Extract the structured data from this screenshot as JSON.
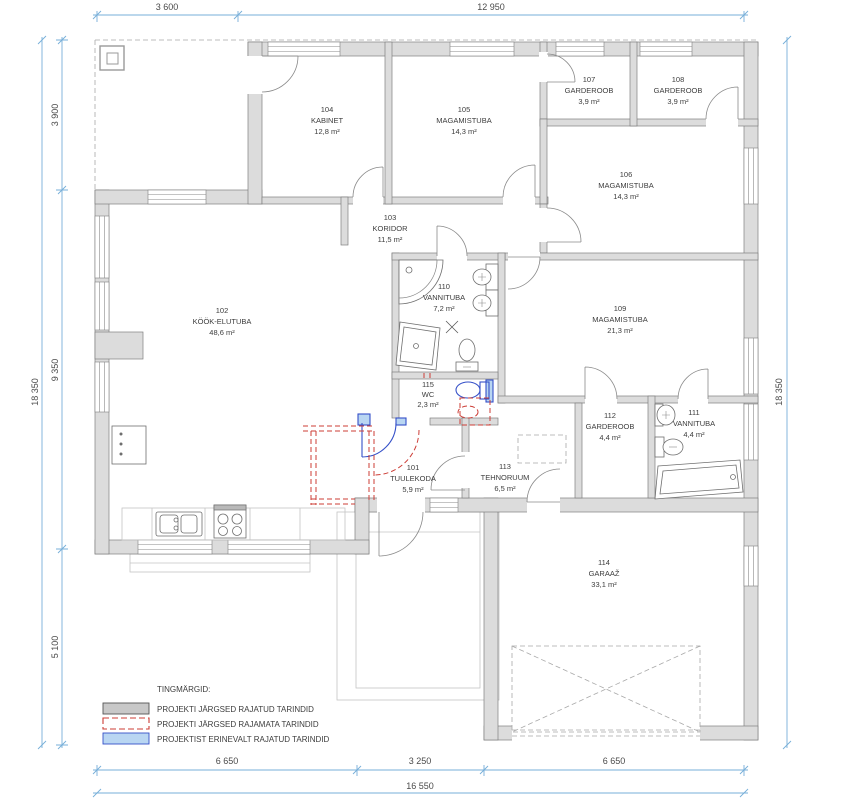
{
  "plan": {
    "rooms": [
      {
        "number": "101",
        "name": "TUULEKODA",
        "area": "5,9 m²"
      },
      {
        "number": "102",
        "name": "KÖÖK-ELUTUBA",
        "area": "48,6 m²"
      },
      {
        "number": "103",
        "name": "KORIDOR",
        "area": "11,5 m²"
      },
      {
        "number": "104",
        "name": "KABINET",
        "area": "12,8 m²"
      },
      {
        "number": "105",
        "name": "MAGAMISTUBA",
        "area": "14,3 m²"
      },
      {
        "number": "106",
        "name": "MAGAMISTUBA",
        "area": "14,3 m²"
      },
      {
        "number": "107",
        "name": "GARDEROOB",
        "area": "3,9 m²"
      },
      {
        "number": "108",
        "name": "GARDEROOB",
        "area": "3,9 m²"
      },
      {
        "number": "109",
        "name": "MAGAMISTUBA",
        "area": "21,3 m²"
      },
      {
        "number": "110",
        "name": "VANNITUBA",
        "area": "7,2 m²"
      },
      {
        "number": "111",
        "name": "VANNITUBA",
        "area": "4,4 m²"
      },
      {
        "number": "112",
        "name": "GARDEROOB",
        "area": "4,4 m²"
      },
      {
        "number": "113",
        "name": "TEHNORUUM",
        "area": "6,5 m²"
      },
      {
        "number": "114",
        "name": "GARAAŽ",
        "area": "33,1 m²"
      },
      {
        "number": "115",
        "name": "WC",
        "area": "2,3 m²"
      }
    ]
  },
  "dimensions": {
    "top": [
      "3 600",
      "12 950"
    ],
    "left_total": "18 350",
    "left_segments": [
      "3 900",
      "9 350",
      "5 100"
    ],
    "right_total": "18 350",
    "bottom_segments": [
      "6 650",
      "3 250",
      "6 650"
    ],
    "bottom_total": "16 550"
  },
  "legend": {
    "title": "TINGMÄRGID:",
    "items": [
      {
        "swatch": "solid-gray",
        "label": "PROJEKTI JÄRGSED RAJATUD TARINDID"
      },
      {
        "swatch": "dashed-red",
        "label": "PROJEKTI JÄRGSED RAJAMATA TARINDID"
      },
      {
        "swatch": "solid-blue",
        "label": "PROJEKTIST ERINEVALT RAJATUD TARINDID"
      }
    ]
  },
  "colors": {
    "wall_fill": "#dcdcdc",
    "dimension_blue": "#77afd9",
    "unbuilt_red": "#cc3d36",
    "modified_blue": "#3550c8",
    "modified_blue_fill": "#b9d6f2"
  }
}
